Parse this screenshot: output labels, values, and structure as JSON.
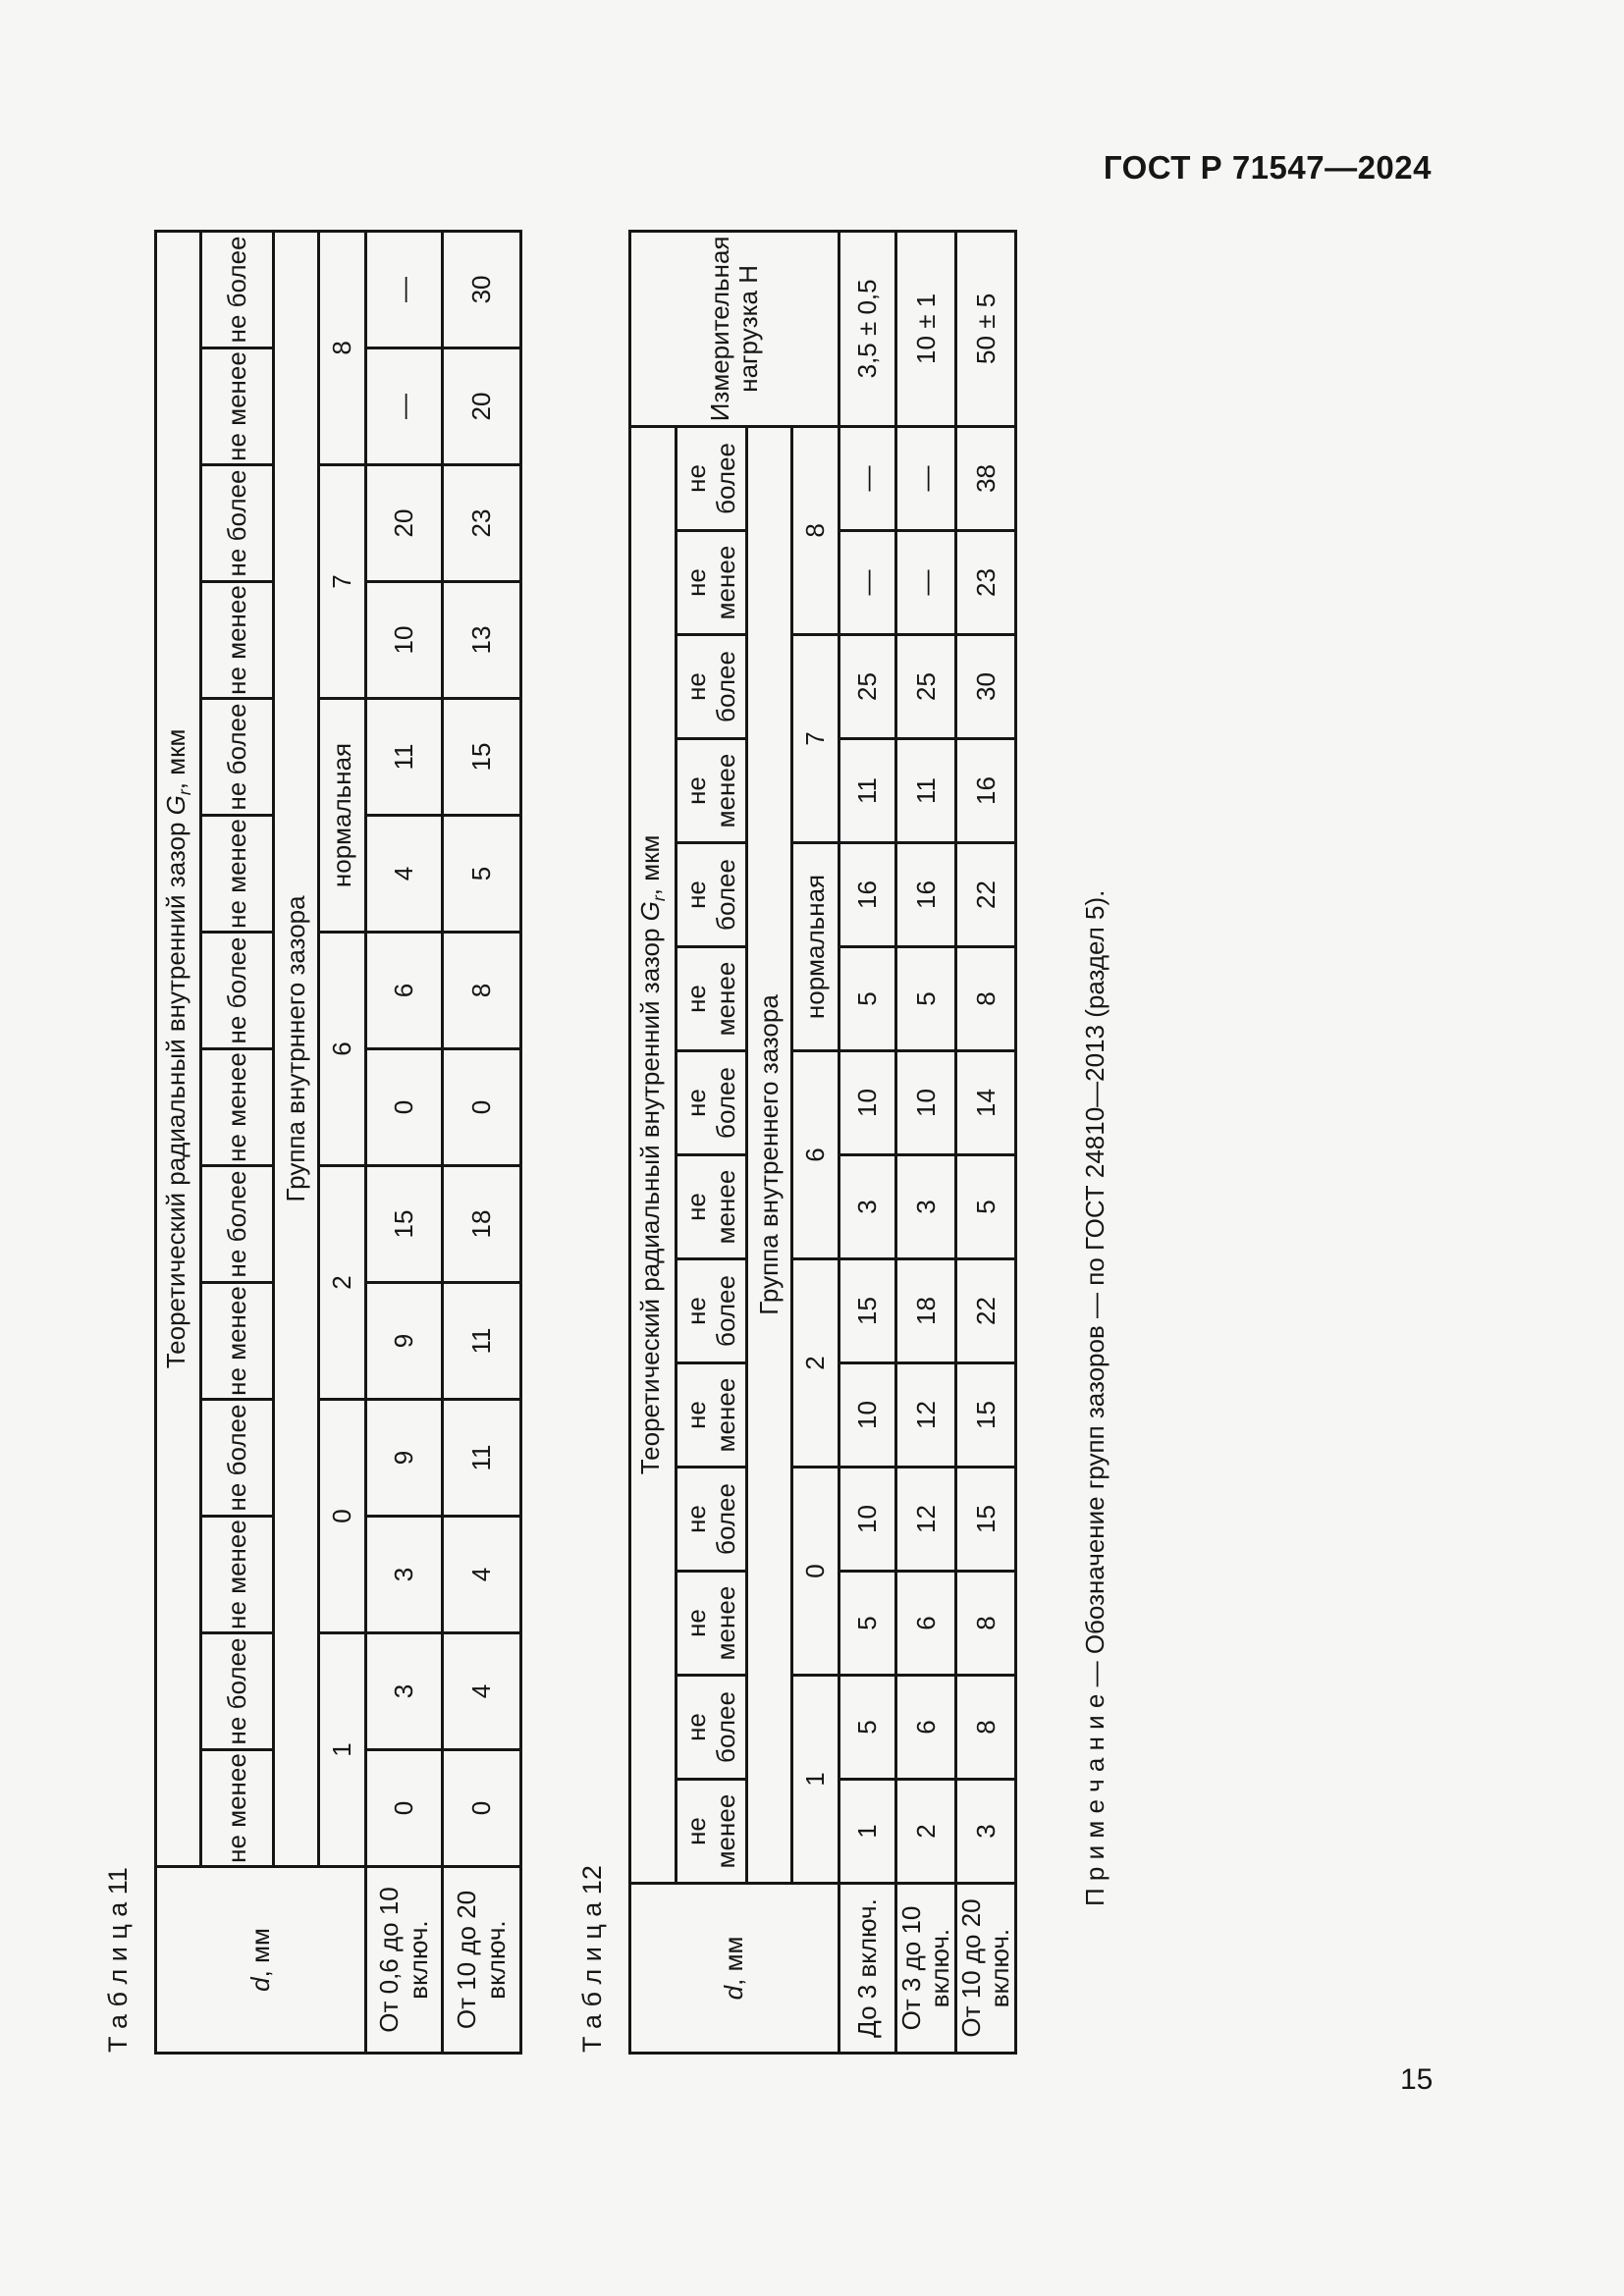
{
  "page": {
    "header": "ГОСТ Р 71547—2024",
    "page_number": "15"
  },
  "colors": {
    "page_bg": "#f6f6f5",
    "ink": "#161616"
  },
  "shared": {
    "d_italic": "d",
    "d_unit": ", мм",
    "title_pre": "Теоретический радиальный внутренний зазор ",
    "title_sym": "G",
    "title_sub": "r",
    "title_post": ", мкм",
    "sub_min": "не менее",
    "sub_max": "не более",
    "groups": [
      "1",
      "0",
      "2",
      "6",
      "нормальная",
      "7",
      "8"
    ]
  },
  "table11": {
    "label": "Т а б л и ц а  11",
    "group_band": "Группа внутрннего зазора",
    "rows": [
      {
        "label": "От 0,6 до 10 включ.",
        "values": [
          "0",
          "3",
          "3",
          "9",
          "9",
          "15",
          "0",
          "6",
          "4",
          "11",
          "10",
          "20",
          "—",
          "—"
        ]
      },
      {
        "label": "От 10 до 20 включ.",
        "values": [
          "0",
          "4",
          "4",
          "11",
          "11",
          "18",
          "0",
          "8",
          "5",
          "15",
          "13",
          "23",
          "20",
          "30"
        ]
      }
    ]
  },
  "table12": {
    "label": "Т а б л и ц а  12",
    "group_band": "Группа внутреннего зазора",
    "load_header": "Измерительная нагрузка Н",
    "rows": [
      {
        "label": "До 3 включ.",
        "values": [
          "1",
          "5",
          "5",
          "10",
          "10",
          "15",
          "3",
          "10",
          "5",
          "16",
          "11",
          "25",
          "—",
          "—"
        ],
        "load": "3,5 ± 0,5"
      },
      {
        "label": "От 3 до 10 включ.",
        "values": [
          "2",
          "6",
          "6",
          "12",
          "12",
          "18",
          "3",
          "10",
          "5",
          "16",
          "11",
          "25",
          "—",
          "—"
        ],
        "load": "10 ± 1"
      },
      {
        "label": "От 10 до 20 включ.",
        "values": [
          "3",
          "8",
          "8",
          "15",
          "15",
          "22",
          "5",
          "14",
          "8",
          "22",
          "16",
          "30",
          "23",
          "38"
        ],
        "load": "50 ± 5"
      }
    ]
  },
  "note": {
    "label": "П р и м е ч а н и е",
    "text": " — Обозначение групп зазоров — по ГОСТ 24810—2013 (раздел 5)."
  }
}
